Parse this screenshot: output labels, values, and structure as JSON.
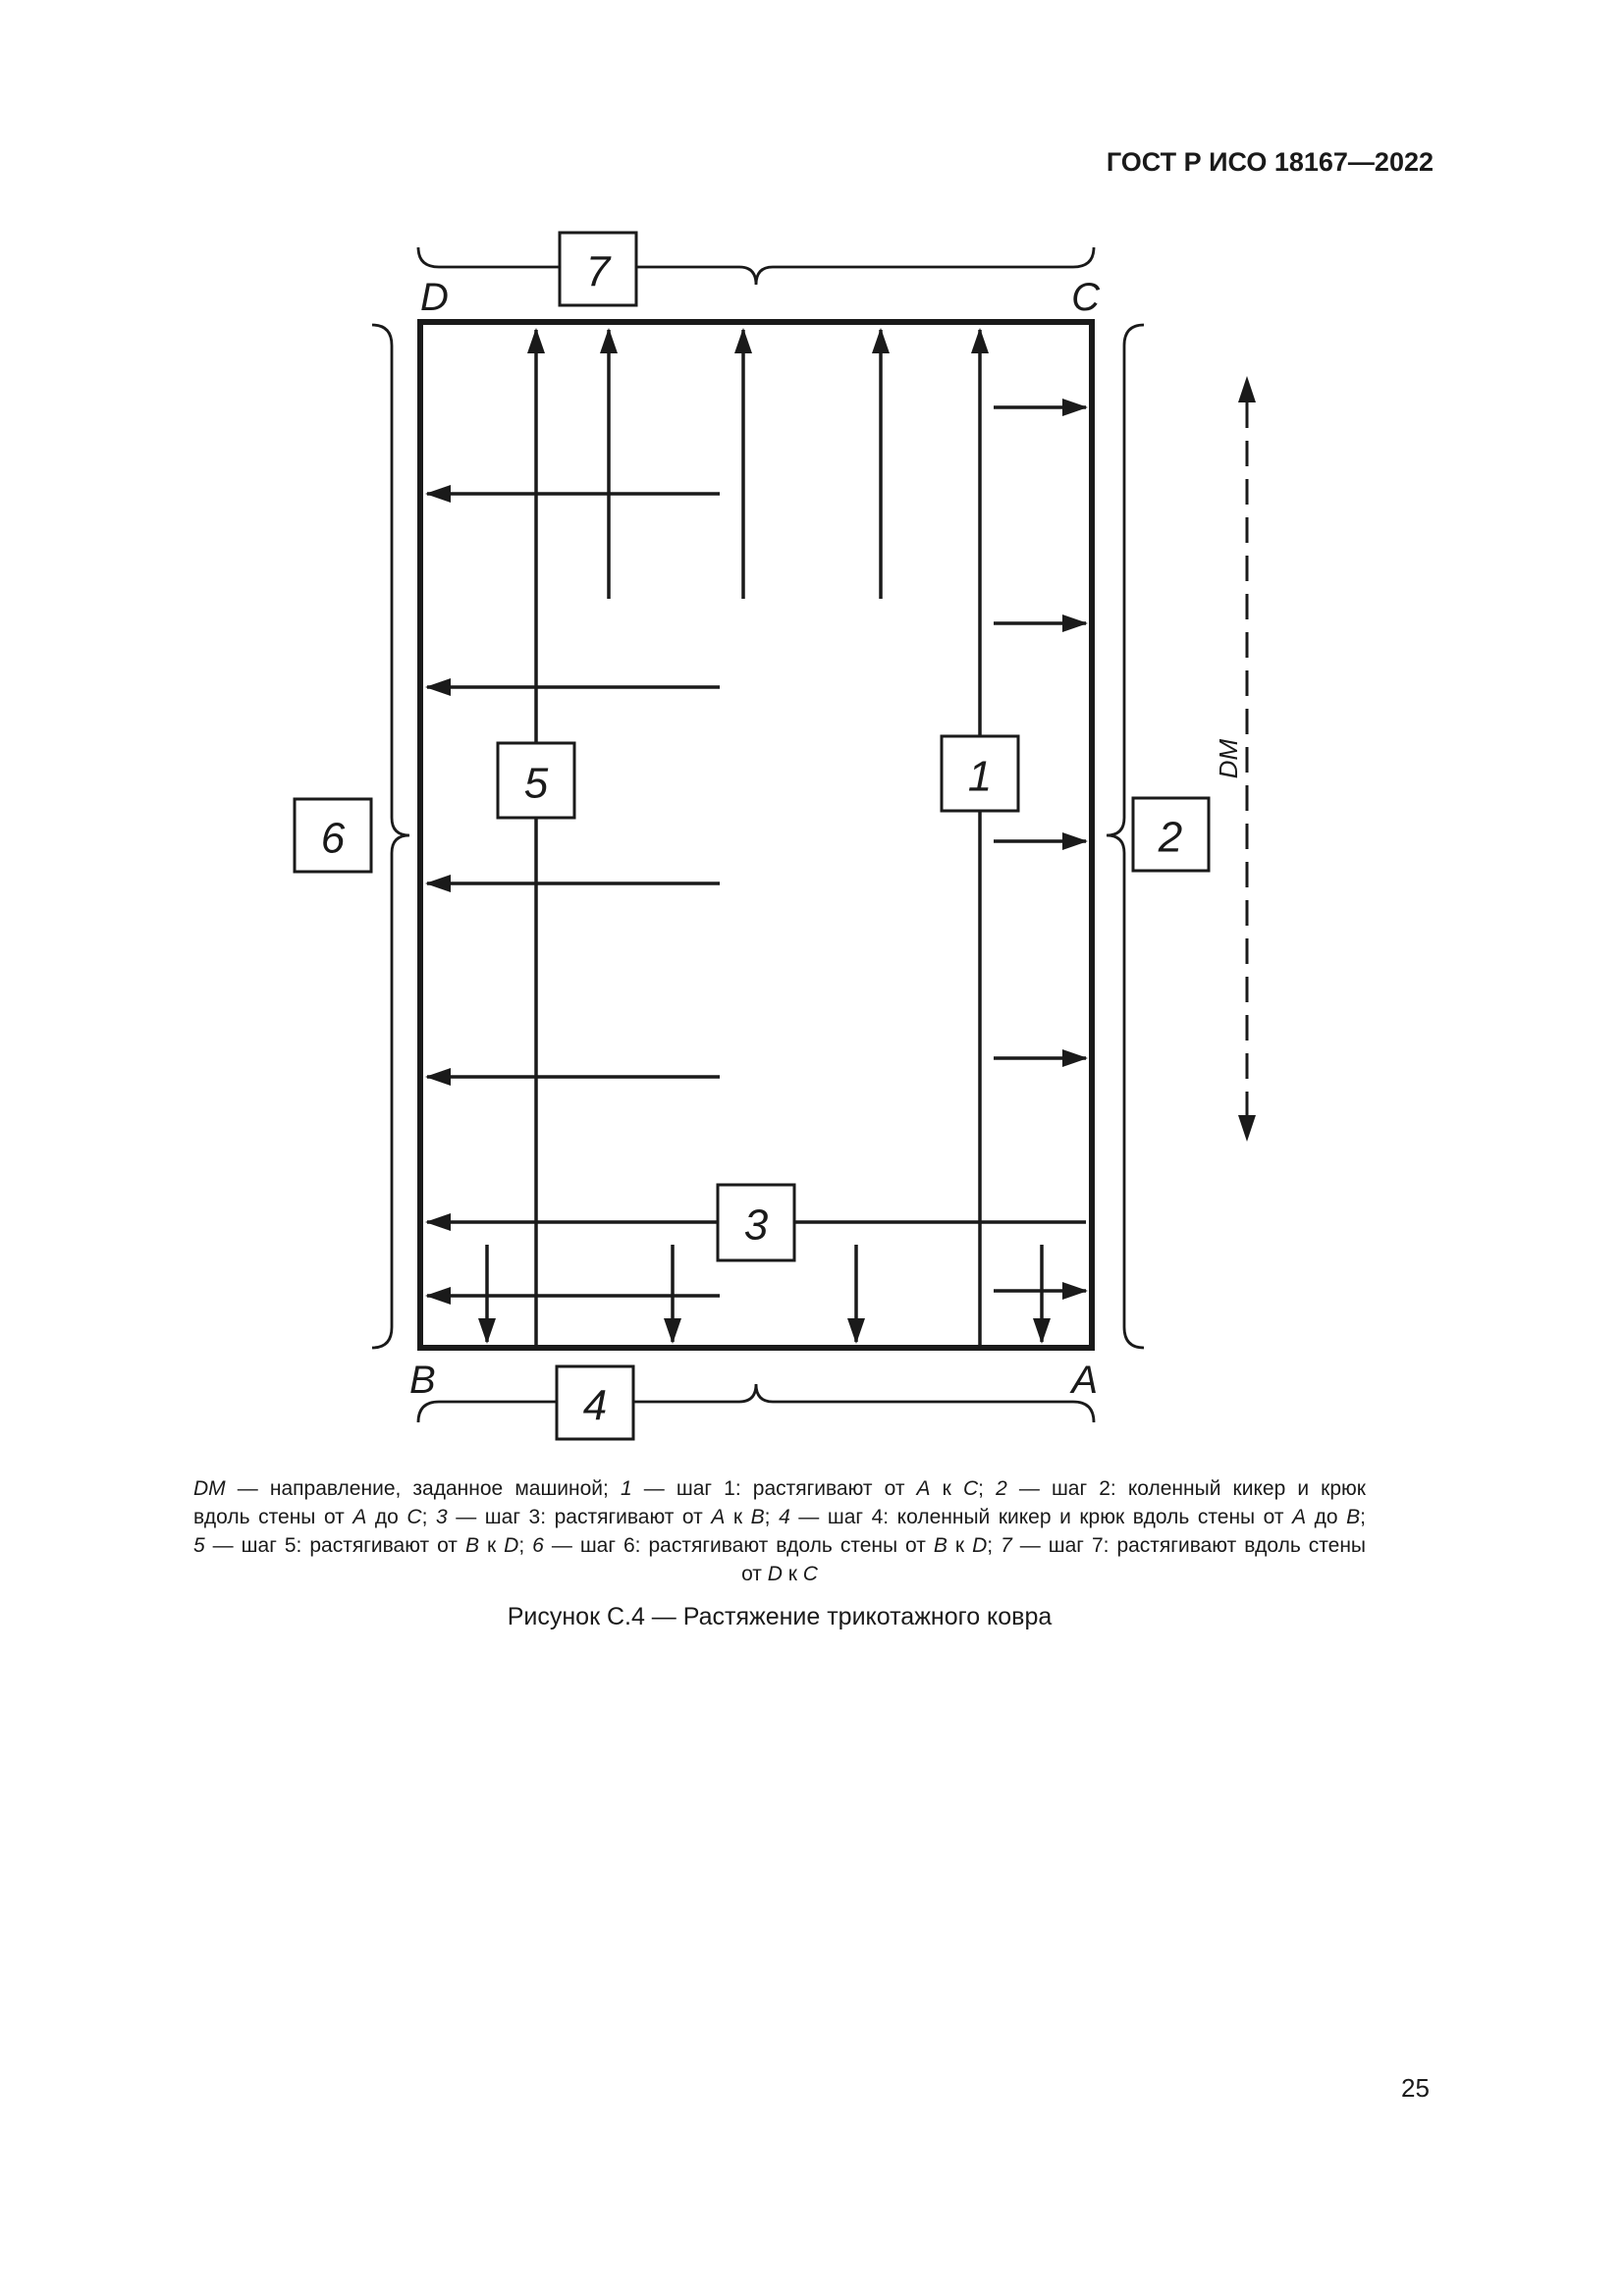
{
  "page": {
    "header_title": "ГОСТ Р ИСО 18167—2022",
    "page_number": "25"
  },
  "figure": {
    "caption": "Рисунок С.4 — Растяжение трикотажного ковра",
    "corners": {
      "top_left": "D",
      "top_right": "C",
      "bottom_left": "B",
      "bottom_right": "A"
    },
    "boxes": {
      "b1": "1",
      "b2": "2",
      "b3": "3",
      "b4": "4",
      "b5": "5",
      "b6": "6",
      "b7": "7"
    },
    "machine_direction_label": "DM",
    "colors": {
      "ink": "#1a1a1a",
      "paper": "#ffffff"
    },
    "legend_lines": [
      {
        "align": "justify",
        "segments": [
          {
            "text": "DM",
            "italic": true
          },
          {
            "text": " — направление, заданное машиной; ",
            "italic": false
          },
          {
            "text": "1",
            "italic": true
          },
          {
            "text": " — шаг 1: растягивают от ",
            "italic": false
          },
          {
            "text": "A",
            "italic": true
          },
          {
            "text": " к ",
            "italic": false
          },
          {
            "text": "C",
            "italic": true
          },
          {
            "text": "; ",
            "italic": false
          },
          {
            "text": "2",
            "italic": true
          },
          {
            "text": " — шаг 2: коленный кикер и крюк",
            "italic": false
          }
        ]
      },
      {
        "align": "justify",
        "segments": [
          {
            "text": "вдоль стены от ",
            "italic": false
          },
          {
            "text": "A",
            "italic": true
          },
          {
            "text": " до ",
            "italic": false
          },
          {
            "text": "C",
            "italic": true
          },
          {
            "text": "; ",
            "italic": false
          },
          {
            "text": "3",
            "italic": true
          },
          {
            "text": " — шаг 3: растягивают от ",
            "italic": false
          },
          {
            "text": "A",
            "italic": true
          },
          {
            "text": " к ",
            "italic": false
          },
          {
            "text": "B",
            "italic": true
          },
          {
            "text": "; ",
            "italic": false
          },
          {
            "text": "4",
            "italic": true
          },
          {
            "text": " — шаг 4: коленный кикер и крюк вдоль стены от ",
            "italic": false
          },
          {
            "text": "A",
            "italic": true
          },
          {
            "text": " до ",
            "italic": false
          },
          {
            "text": "B",
            "italic": true
          },
          {
            "text": ";",
            "italic": false
          }
        ]
      },
      {
        "align": "justify",
        "segments": [
          {
            "text": "5",
            "italic": true
          },
          {
            "text": " — шаг 5: растягивают от ",
            "italic": false
          },
          {
            "text": "B",
            "italic": true
          },
          {
            "text": " к ",
            "italic": false
          },
          {
            "text": "D",
            "italic": true
          },
          {
            "text": "; ",
            "italic": false
          },
          {
            "text": "6",
            "italic": true
          },
          {
            "text": " — шаг 6: растягивают вдоль стены от ",
            "italic": false
          },
          {
            "text": "B",
            "italic": true
          },
          {
            "text": " к ",
            "italic": false
          },
          {
            "text": "D",
            "italic": true
          },
          {
            "text": "; ",
            "italic": false
          },
          {
            "text": "7",
            "italic": true
          },
          {
            "text": " — шаг 7: растягивают вдоль стены",
            "italic": false
          }
        ]
      },
      {
        "align": "center",
        "segments": [
          {
            "text": "от ",
            "italic": false
          },
          {
            "text": "D",
            "italic": true
          },
          {
            "text": " к ",
            "italic": false
          },
          {
            "text": "C",
            "italic": true
          }
        ]
      }
    ]
  }
}
